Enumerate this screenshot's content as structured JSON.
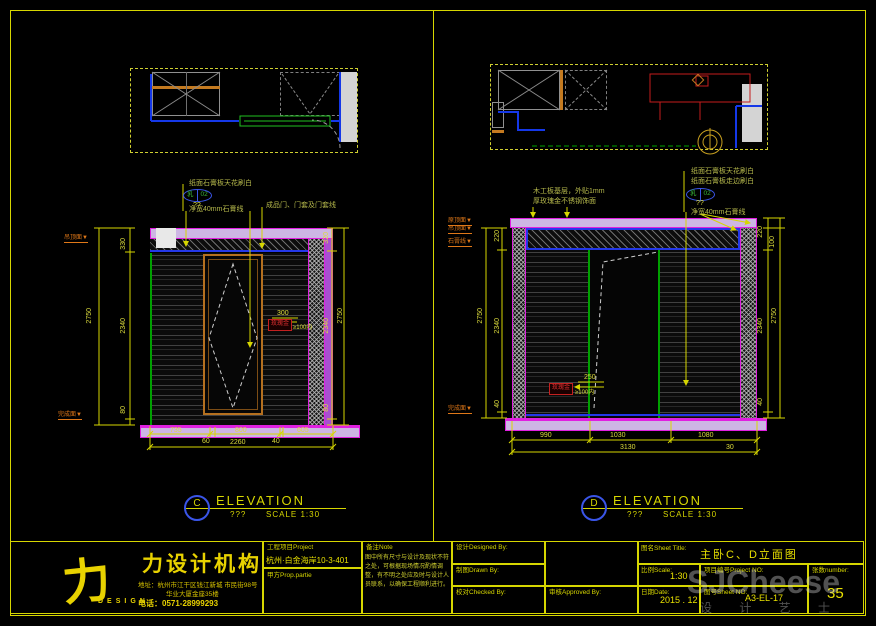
{
  "colors": {
    "accent_yellow": "#d6d600",
    "magenta": "#ff00ff",
    "band_fill": "#cdb6e4",
    "blue": "#2438e8",
    "green": "#00a000",
    "orange_frame": "#b5701f",
    "marker_orange": "#e07818",
    "red_tag": "#c42020",
    "note_green": "#b7ba4c"
  },
  "elev_c": {
    "letter": "C",
    "title": "ELEVATION",
    "subtitle": "???",
    "scale": "SCALE 1:30",
    "note1": "纸面石膏板天花刷白",
    "note2": "净宽40mm石膏线",
    "note3": "成品门、门套及门套线",
    "tag_a": "乳",
    "tag_b": "02",
    "tag_q": "??",
    "marker_top": "吊顶面▼",
    "marker_bottom": "完成面▼",
    "dim_left_total": "2750",
    "dim_left": [
      "330",
      "2340",
      "80"
    ],
    "dim_right": [
      "320",
      "2340",
      "80"
    ],
    "dim_right_total": "2750",
    "dims_bottom": [
      "735",
      "800",
      "605"
    ],
    "dims_bottom2": [
      "60",
      "2260",
      "40"
    ],
    "red_dim": "300",
    "red_box": "玫瑰金",
    "red_note": "≥100内"
  },
  "elev_d": {
    "letter": "D",
    "title": "ELEVATION",
    "subtitle": "???",
    "scale": "SCALE 1:30",
    "note_l1": "木工板基层，外贴1mm",
    "note_l2": "厚玫瑰金不锈钢饰面",
    "note_r1": "纸面石膏板天花刷白",
    "note_r2": "纸面石膏板走边刷白",
    "note_r3": "净宽40mm石膏线",
    "tag_a": "乳",
    "tag_b": "02",
    "tag_q": "??",
    "markers_left": [
      "原顶面▼",
      "吊顶面▼",
      "石膏线▼"
    ],
    "marker_bottom": "完成面▼",
    "dim_left_total": "2750",
    "dim_left": [
      "220",
      "2340",
      "40"
    ],
    "dim_right": [
      "220",
      "100",
      "2340",
      "40"
    ],
    "dim_right_total": "2750",
    "dims_bottom": [
      "990",
      "1030",
      "1080"
    ],
    "dim_bottom_total": "3130",
    "dim_bottom_right": "30",
    "red_dim": "250",
    "red_box": "玫瑰金",
    "red_note": "≥100内"
  },
  "title_block": {
    "logo_glyph": "力",
    "logo_design": "DESIGN",
    "company": "力设计机构",
    "address1": "地址：杭州市江干区钱江新城 市民街98号",
    "address2": "华业大厦金座35楼",
    "phone": "电话：0571-28999293",
    "project_label": "工程项目Project",
    "project_value": "杭州·白金海岸10-3-401",
    "party_label": "甲方Prop.partie",
    "note_label": "备注Note",
    "note_text": "图中所有尺寸与设计及现状不符之处，可根据现场情况酌情调整，有不明之处应及时与设计人员联系，以确保工程顺利进行。",
    "designed_label": "设计Designed By:",
    "drawn_label": "制图Drawn By:",
    "checked_label": "校对Checked By:",
    "approved_label": "审核Approved By:",
    "sheet_title_label": "图名Sheet Title:",
    "sheet_title_value": "主卧C、D立面图",
    "scale_label": "比例Scale:",
    "scale_value": "1:30",
    "project_no_label": "项目编号Project NO:",
    "date_label": "日期Date:",
    "date_value": "2015 . 12",
    "sheet_no_label": "图号Sheet NO:",
    "sheet_no_value": "A3-EL-17",
    "number_label": "张数number:",
    "number_value": "35"
  },
  "watermark": {
    "main": "SJCheese",
    "sub": "设 计 艺 士"
  }
}
